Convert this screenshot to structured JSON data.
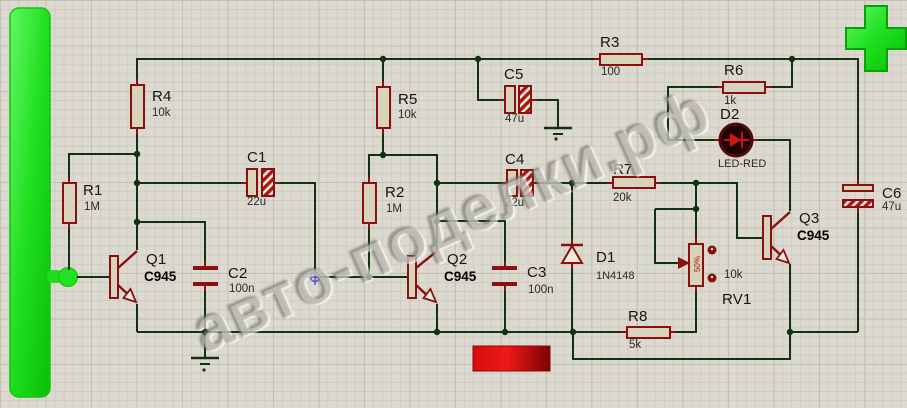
{
  "app": {
    "view": "schematic-capture-canvas"
  },
  "watermark_text": "авто-поделки.рф",
  "colors": {
    "background": "#dcd9d0",
    "grid_minor": "#cfccc1",
    "grid_major": "#c3c0b4",
    "wire": "#14310f",
    "component_outline": "#8a1010",
    "component_fill": "#d8d4bc",
    "terminal_green": "#1ede1e",
    "terminal_red": "#d60d0d",
    "led_body": "#1f0406"
  },
  "components": [
    {
      "ref": "R1",
      "value": "1M",
      "type": "resistor"
    },
    {
      "ref": "R4",
      "value": "10k",
      "type": "resistor"
    },
    {
      "ref": "R5",
      "value": "10k",
      "type": "resistor"
    },
    {
      "ref": "R2",
      "value": "1M",
      "type": "resistor"
    },
    {
      "ref": "R3",
      "value": "100",
      "type": "resistor"
    },
    {
      "ref": "R6",
      "value": "1k",
      "type": "resistor"
    },
    {
      "ref": "R7",
      "value": "20k",
      "type": "resistor"
    },
    {
      "ref": "R8",
      "value": "5k",
      "type": "resistor"
    },
    {
      "ref": "C1",
      "value": "22u",
      "type": "capacitor-electrolytic"
    },
    {
      "ref": "C2",
      "value": "100n",
      "type": "capacitor"
    },
    {
      "ref": "C3",
      "value": "100n",
      "type": "capacitor"
    },
    {
      "ref": "C4",
      "value": "22u",
      "type": "capacitor-electrolytic"
    },
    {
      "ref": "C5",
      "value": "47u",
      "type": "capacitor-electrolytic"
    },
    {
      "ref": "C6",
      "value": "47u",
      "type": "capacitor-electrolytic"
    },
    {
      "ref": "Q1",
      "value": "C945",
      "type": "npn-transistor"
    },
    {
      "ref": "Q2",
      "value": "C945",
      "type": "npn-transistor"
    },
    {
      "ref": "Q3",
      "value": "C945",
      "type": "npn-transistor"
    },
    {
      "ref": "D1",
      "value": "1N4148",
      "type": "diode"
    },
    {
      "ref": "D2",
      "value": "LED-RED",
      "type": "led"
    },
    {
      "ref": "RV1",
      "value": "10k",
      "wiper": "50%",
      "type": "potentiometer"
    }
  ]
}
